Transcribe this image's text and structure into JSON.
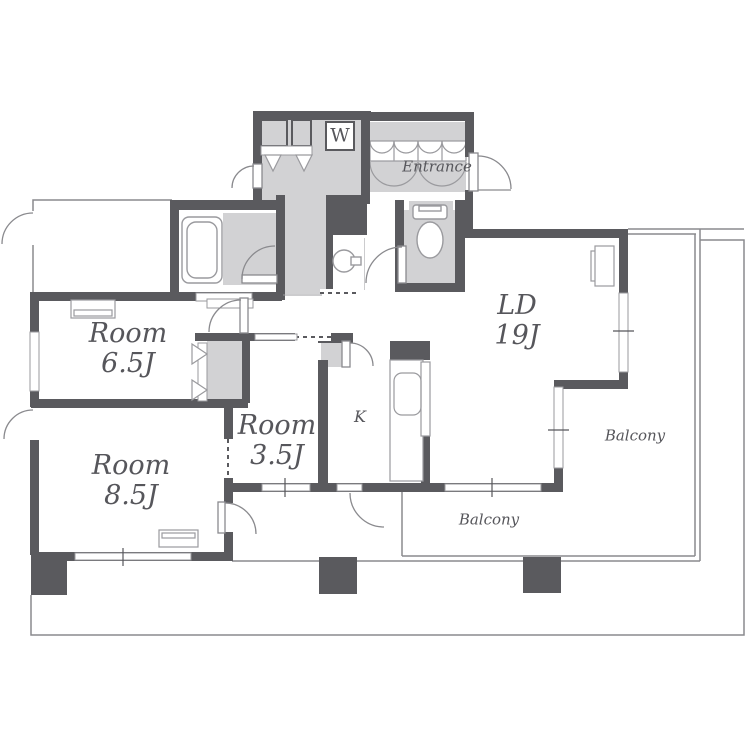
{
  "title": "Apartment floor plan",
  "colors": {
    "wall": "#5a5a5e",
    "floor": "#d2d2d4",
    "line": "#8a8a8e",
    "fixline": "#9a9a9e",
    "text": "#56565b",
    "bg": "#ffffff"
  },
  "labels": {
    "room_65": {
      "name": "Room",
      "size": "6.5J"
    },
    "room_85": {
      "name": "Room",
      "size": "8.5J"
    },
    "room_35": {
      "name": "Room",
      "size": "3.5J"
    },
    "ld": {
      "name": "LD",
      "size": "19J"
    },
    "kitchen": "K",
    "entrance": "Entrance",
    "washer": "W",
    "balcony_right": "Balcony",
    "balcony_bottom": "Balcony"
  }
}
